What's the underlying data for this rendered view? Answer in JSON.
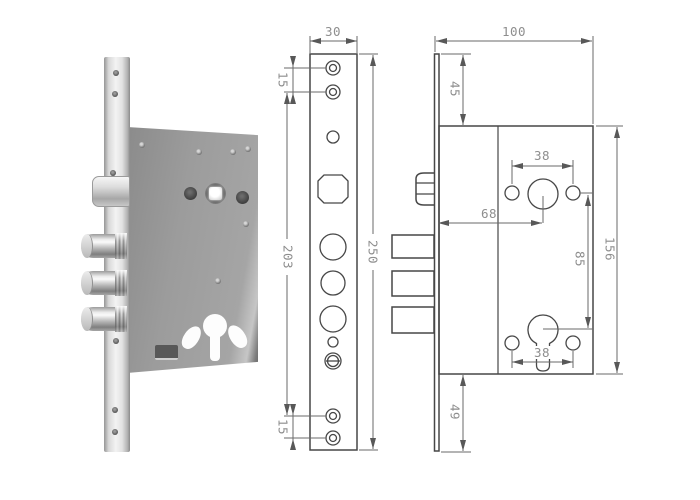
{
  "front_view": {
    "plate_width": "30",
    "top_screw_spacing": "15",
    "screw_hole_span": "203",
    "plate_height": "250",
    "bottom_screw_spacing": "15"
  },
  "side_view": {
    "body_depth": "100",
    "top_offset": "45",
    "handle_screw_spacing": "38",
    "backset": "68",
    "handle_to_cylinder": "85",
    "body_height": "156",
    "cylinder_screw_spacing": "38",
    "bottom_offset": "49"
  },
  "colors": {
    "outline": "#474747",
    "dimension_line": "#6a6a6a",
    "dimension_text": "#8e8e8e",
    "background": "#ffffff",
    "lock_body_gray": "#9c9c9c",
    "chrome_light": "#f3f3f3"
  }
}
